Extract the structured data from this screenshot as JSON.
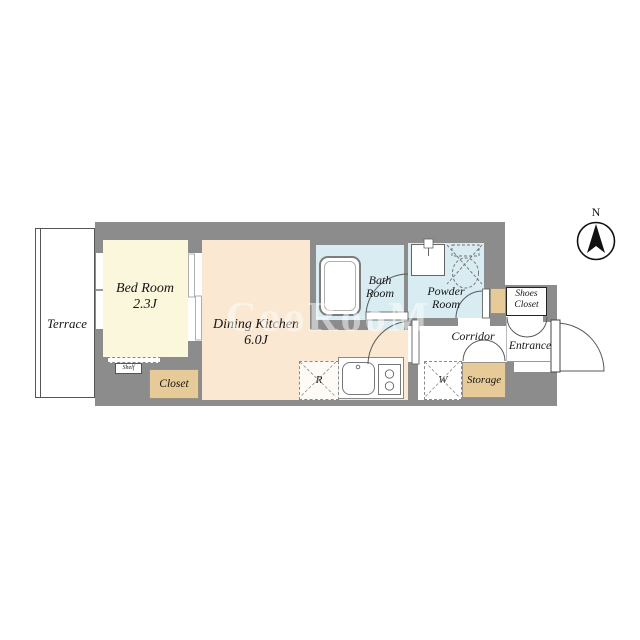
{
  "watermark": "CooRooM",
  "compass": {
    "label": "N"
  },
  "rooms": {
    "terrace": {
      "label": "Terrace"
    },
    "bedroom": {
      "name": "Bed Room",
      "size": "2.3J"
    },
    "dining_kitchen": {
      "name": "Dining Kitchen",
      "size": "6.0J"
    },
    "bath_room": {
      "line1": "Bath",
      "line2": "Room"
    },
    "powder_room": {
      "line1": "Powder",
      "line2": "Room"
    },
    "corridor": {
      "label": "Corridor"
    },
    "entrance": {
      "label": "Entrance"
    },
    "shoes_closet": {
      "line1": "Shoes",
      "line2": "Closet"
    },
    "storage": {
      "label": "Storage"
    },
    "closet": {
      "label": "Closet"
    },
    "shelf": {
      "label": "Shelf"
    }
  },
  "fixtures": {
    "refrigerator_label": "R",
    "washer_label": "W"
  },
  "colors": {
    "wall": "#8C8C8C",
    "bedroom_floor": "#FBF7DC",
    "dining_kitchen_floor": "#FAE8D2",
    "wet_area_floor": "#D8ECF2",
    "closet_fill": "#E6CA98",
    "watermark": "#FFFFFF"
  }
}
